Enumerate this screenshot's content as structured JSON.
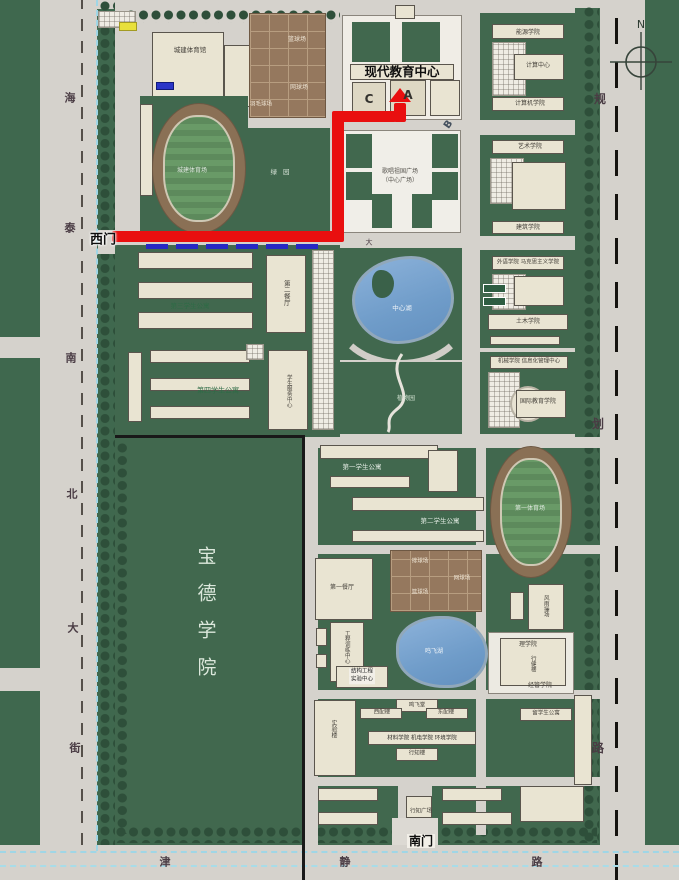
{
  "map": {
    "compass_label": "N",
    "streets": {
      "west_vertical_street": "海泰南北大街",
      "east_vertical_road": "规划路",
      "south_road": "津静路"
    },
    "gates": {
      "west": "西门",
      "south": "南门"
    },
    "route": {
      "color": "#e90f0f",
      "description_labels": [
        "西门",
        "现代教育中心",
        "A"
      ],
      "bars": [
        {
          "x": 112,
          "y": 231,
          "w": 226,
          "h": 11
        },
        {
          "x": 332,
          "y": 118,
          "w": 12,
          "h": 124
        },
        {
          "x": 332,
          "y": 111,
          "w": 64,
          "h": 11
        },
        {
          "x": 394,
          "y": 103,
          "w": 12,
          "h": 19
        }
      ],
      "arrow": {
        "x": 400,
        "y": 88,
        "halfw": 11,
        "h": 14
      },
      "start_marker": {
        "x": 146,
        "y": 244,
        "w": 172,
        "h": 5,
        "color": "#2727c4"
      }
    },
    "labels": [
      {
        "id": "street-west-char-1",
        "text": "海",
        "x": 70,
        "y": 98,
        "size": 11,
        "color": "#4a3c44",
        "bold": 1
      },
      {
        "id": "street-west-char-2",
        "text": "泰",
        "x": 70,
        "y": 228,
        "size": 11,
        "color": "#4a3c44",
        "bold": 1
      },
      {
        "id": "street-west-char-3",
        "text": "南",
        "x": 71,
        "y": 358,
        "size": 11,
        "color": "#4a3c44",
        "bold": 1
      },
      {
        "id": "street-west-char-4",
        "text": "北",
        "x": 72,
        "y": 494,
        "size": 11,
        "color": "#4a3c44",
        "bold": 1
      },
      {
        "id": "street-west-char-5",
        "text": "大",
        "x": 73,
        "y": 628,
        "size": 11,
        "color": "#4a3c44",
        "bold": 1
      },
      {
        "id": "street-west-char-6",
        "text": "街",
        "x": 75,
        "y": 748,
        "size": 11,
        "color": "#4a3c44",
        "bold": 1
      },
      {
        "id": "street-east-char-1",
        "text": "规",
        "x": 600,
        "y": 99,
        "size": 12,
        "color": "#4a3c44",
        "bold": 1
      },
      {
        "id": "street-east-char-2",
        "text": "划",
        "x": 598,
        "y": 424,
        "size": 12,
        "color": "#4a3c44",
        "bold": 1
      },
      {
        "id": "street-east-char-3",
        "text": "路",
        "x": 598,
        "y": 748,
        "size": 12,
        "color": "#4a3c44",
        "bold": 1
      },
      {
        "id": "street-south-char-1",
        "text": "津",
        "x": 165,
        "y": 862,
        "size": 11,
        "color": "#4a3c44",
        "bold": 1
      },
      {
        "id": "street-south-char-2",
        "text": "静",
        "x": 345,
        "y": 862,
        "size": 11,
        "color": "#4a3c44",
        "bold": 1
      },
      {
        "id": "street-south-char-3",
        "text": "路",
        "x": 537,
        "y": 862,
        "size": 11,
        "color": "#4a3c44",
        "bold": 1
      },
      {
        "id": "west-gate",
        "text": "西门",
        "x": 103,
        "y": 240,
        "size": 13,
        "color": "#0d0d0d",
        "bold": 1,
        "halo": 1
      },
      {
        "id": "south-gate",
        "text": "南门",
        "x": 421,
        "y": 841,
        "size": 12,
        "color": "#0d0d0d",
        "bold": 1,
        "bg": "#f2efe8"
      },
      {
        "id": "modern-education-center",
        "text": "现代教育中心",
        "x": 402,
        "y": 72,
        "size": 12.5,
        "color": "#0f0f0f",
        "bold": 1
      },
      {
        "id": "building-a",
        "text": "A",
        "x": 408,
        "y": 95,
        "size": 12,
        "color": "#33322e",
        "bold": 1
      },
      {
        "id": "building-c",
        "text": "C",
        "x": 369,
        "y": 99,
        "size": 12,
        "color": "#33322e",
        "bold": 1
      },
      {
        "id": "building-b",
        "text": "B",
        "x": 449,
        "y": 125,
        "size": 10,
        "color": "#44505e",
        "bold": 1,
        "rot": -55
      },
      {
        "id": "baode-college",
        "text": "宝德学院",
        "x": 205,
        "y": 620,
        "size": 19,
        "color": "#dce8dc",
        "v": 1,
        "ls": 18
      },
      {
        "id": "central-lake",
        "text": "中心湖",
        "x": 402,
        "y": 308,
        "size": 6.5,
        "color": "#eef3f8"
      },
      {
        "id": "mingfei-lake",
        "text": "鸣飞湖",
        "x": 434,
        "y": 652,
        "size": 6,
        "color": "#eef3f8"
      },
      {
        "id": "botanical-garden",
        "text": "植物园",
        "x": 406,
        "y": 399,
        "size": 6,
        "color": "#cfe0cf"
      },
      {
        "id": "central-plaza-line1",
        "text": "歌唱祖国广场",
        "x": 400,
        "y": 172,
        "size": 6,
        "color": "#55524c"
      },
      {
        "id": "central-plaza-line2",
        "text": "（中心广场）",
        "x": 400,
        "y": 181,
        "size": 6,
        "color": "#55524c"
      },
      {
        "id": "gymnasium",
        "text": "城建体育馆",
        "x": 190,
        "y": 50,
        "size": 6.5,
        "color": "#44403a"
      },
      {
        "id": "main-stadium",
        "text": "城建体育场",
        "x": 192,
        "y": 171,
        "size": 6,
        "color": "#dfe8df"
      },
      {
        "id": "basketball-courts",
        "text": "篮球场",
        "x": 297,
        "y": 40,
        "size": 6,
        "color": "#efe6d6"
      },
      {
        "id": "tennis-courts",
        "text": "网球场",
        "x": 299,
        "y": 88,
        "size": 6,
        "color": "#efe6d6"
      },
      {
        "id": "badminton-courts",
        "text": "羽毛球场",
        "x": 261,
        "y": 105,
        "size": 5.5,
        "color": "#efe6d6"
      },
      {
        "id": "green-garden",
        "text": "绿园",
        "x": 283,
        "y": 172,
        "size": 6.5,
        "color": "#d8e4d8",
        "ls": 6
      },
      {
        "id": "apartment-3",
        "text": "第三学生公寓",
        "x": 190,
        "y": 306,
        "size": 6.5,
        "color": "#2e6b46"
      },
      {
        "id": "dining-hall-2",
        "text": "第二餐厅",
        "x": 286,
        "y": 293,
        "size": 6.5,
        "color": "#44403a",
        "v": 1
      },
      {
        "id": "apartment-4",
        "text": "第四学生公寓",
        "x": 218,
        "y": 391,
        "size": 7,
        "color": "#2e6b46"
      },
      {
        "id": "student-service-center",
        "text": "学生服务中心",
        "x": 288,
        "y": 391,
        "size": 5.5,
        "color": "#44403a",
        "v": 1
      },
      {
        "id": "apartment-1",
        "text": "第一学生公寓",
        "x": 362,
        "y": 467,
        "size": 6.5,
        "color": "#e4ece4"
      },
      {
        "id": "apartment-2",
        "text": "第二学生公寓",
        "x": 440,
        "y": 521,
        "size": 6.5,
        "color": "#e4ece4"
      },
      {
        "id": "dining-hall-1",
        "text": "第一餐厅",
        "x": 342,
        "y": 588,
        "size": 6,
        "color": "#44403a"
      },
      {
        "id": "volleyball-courts",
        "text": "排球场",
        "x": 420,
        "y": 562,
        "size": 5.5,
        "color": "#efe6d6"
      },
      {
        "id": "tennis-courts-south",
        "text": "网球场",
        "x": 462,
        "y": 579,
        "size": 5.5,
        "color": "#efe6d6"
      },
      {
        "id": "basketball-courts-south",
        "text": "篮球场",
        "x": 420,
        "y": 593,
        "size": 5.5,
        "color": "#efe6d6"
      },
      {
        "id": "engineering-training-center",
        "text": "工程训练中心",
        "x": 346,
        "y": 647,
        "size": 5.5,
        "color": "#44403a",
        "v": 1
      },
      {
        "id": "structural-lab-line1",
        "text": "结构工程",
        "x": 362,
        "y": 672,
        "size": 5.5,
        "color": "#222222",
        "bg": "#f2efe8"
      },
      {
        "id": "structural-lab-line2",
        "text": "实验中心",
        "x": 362,
        "y": 680,
        "size": 5.5,
        "color": "#222222",
        "bg": "#f2efe8"
      },
      {
        "id": "lab-building",
        "text": "实验楼",
        "x": 333,
        "y": 729,
        "size": 6,
        "color": "#44403a",
        "v": 1
      },
      {
        "id": "mingfei-hall",
        "text": "鸣飞堂",
        "x": 417,
        "y": 706,
        "size": 5.5,
        "color": "#44403a"
      },
      {
        "id": "west-annex",
        "text": "西配楼",
        "x": 382,
        "y": 713,
        "size": 5.5,
        "color": "#44403a"
      },
      {
        "id": "east-annex",
        "text": "东配楼",
        "x": 446,
        "y": 713,
        "size": 5.5,
        "color": "#44403a"
      },
      {
        "id": "colleges-row",
        "text": "材料学院 机电学院 环境学院",
        "x": 422,
        "y": 739,
        "size": 5.5,
        "color": "#33322e"
      },
      {
        "id": "xingzhi-building",
        "text": "行知楼",
        "x": 417,
        "y": 754,
        "size": 5.5,
        "color": "#44403a"
      },
      {
        "id": "science-college",
        "text": "理学院",
        "x": 528,
        "y": 645,
        "size": 6,
        "color": "#44403a"
      },
      {
        "id": "xingjian-building",
        "text": "行健楼",
        "x": 532,
        "y": 664,
        "size": 5.5,
        "color": "#44403a",
        "v": 1
      },
      {
        "id": "econ-mgmt-college",
        "text": "经管学院",
        "x": 540,
        "y": 686,
        "size": 6,
        "color": "#44403a"
      },
      {
        "id": "intl-student-apartment",
        "text": "留学生公寓",
        "x": 546,
        "y": 714,
        "size": 5.5,
        "color": "#44403a"
      },
      {
        "id": "indoor-sports-hall",
        "text": "风雨操场",
        "x": 545,
        "y": 606,
        "size": 5.5,
        "color": "#44403a",
        "v": 1
      },
      {
        "id": "stadium-1",
        "text": "第一体育场",
        "x": 530,
        "y": 509,
        "size": 6,
        "color": "#dfe8df"
      },
      {
        "id": "xingzhi-square",
        "text": "行知广场",
        "x": 421,
        "y": 812,
        "size": 5.5,
        "color": "#44403a"
      },
      {
        "id": "energy-college",
        "text": "能源学院",
        "x": 528,
        "y": 33,
        "size": 6,
        "color": "#44403a"
      },
      {
        "id": "computing-center",
        "text": "计算中心",
        "x": 538,
        "y": 66,
        "size": 6,
        "color": "#44403a"
      },
      {
        "id": "computer-college",
        "text": "计算机学院",
        "x": 530,
        "y": 104,
        "size": 6,
        "color": "#44403a"
      },
      {
        "id": "art-college",
        "text": "艺术学院",
        "x": 530,
        "y": 147,
        "size": 6,
        "color": "#44403a"
      },
      {
        "id": "architecture-college",
        "text": "建筑学院",
        "x": 528,
        "y": 228,
        "size": 6,
        "color": "#44403a"
      },
      {
        "id": "foreign-marxism-college",
        "text": "外语学院 马克思主义学院",
        "x": 528,
        "y": 263,
        "size": 5.5,
        "color": "#44403a"
      },
      {
        "id": "civil-college",
        "text": "土木学院",
        "x": 528,
        "y": 322,
        "size": 6,
        "color": "#44403a"
      },
      {
        "id": "mech-info-center",
        "text": "机械学院 信息化管理中心",
        "x": 529,
        "y": 362,
        "size": 5.5,
        "color": "#44403a"
      },
      {
        "id": "intl-education-college",
        "text": "国际教育学院",
        "x": 538,
        "y": 402,
        "size": 6,
        "color": "#44403a"
      },
      {
        "id": "road-char-da",
        "text": "大",
        "x": 369,
        "y": 243,
        "size": 7,
        "color": "#4a3c44"
      }
    ]
  },
  "colors": {
    "lawn": "#3f684e",
    "road": "#d5d2cc",
    "building": "#e9e4d2",
    "courts": "#95785e",
    "lake": "#7ba6d2",
    "route_red": "#e90f0f",
    "route_blue": "#2727c4",
    "boundary_cyan": "#9fd6e6"
  }
}
